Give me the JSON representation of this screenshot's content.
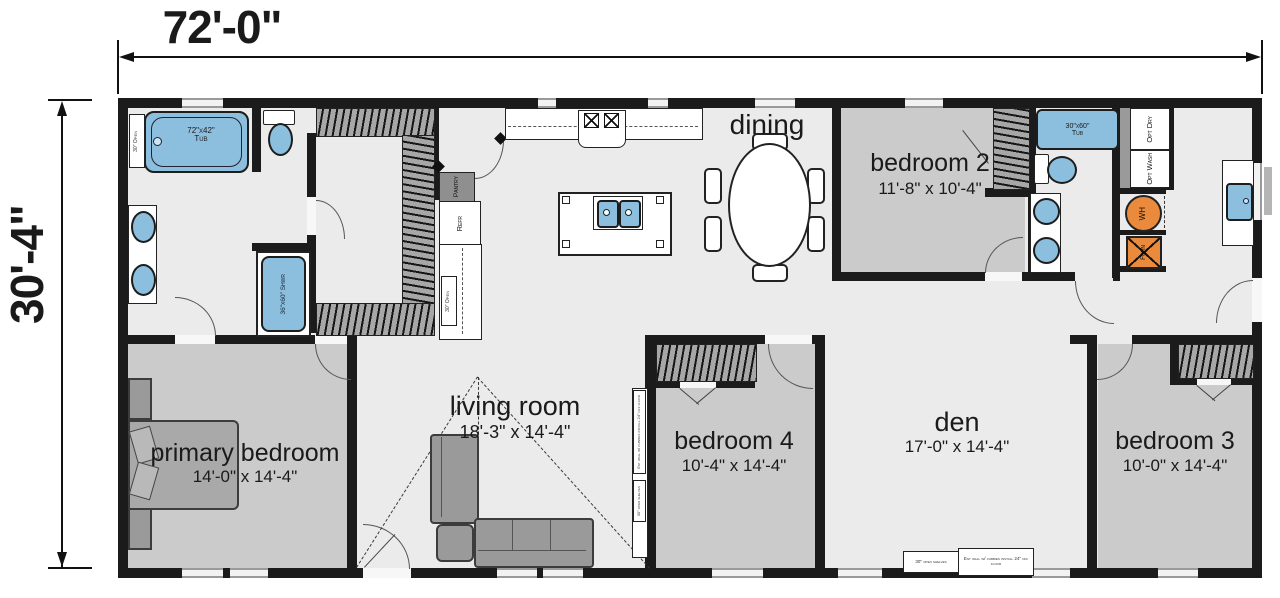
{
  "dimension_labels": {
    "width": "72'-0\"",
    "height": "30'-4\""
  },
  "rooms": {
    "dining": {
      "label": "dining"
    },
    "bedroom2": {
      "label": "bedroom 2",
      "size": "11'-8\" x 10'-4\""
    },
    "primary_bedroom": {
      "label": "primary bedroom",
      "size": "14'-0\" x 14'-4\""
    },
    "living_room": {
      "label": "living room",
      "size": "18'-3\" x 14'-4\""
    },
    "bedroom4": {
      "label": "bedroom 4",
      "size": "10'-4\" x 14'-4\""
    },
    "den": {
      "label": "den",
      "size": "17'-0\" x 14'-4\""
    },
    "bedroom3": {
      "label": "bedroom 3",
      "size": "10'-0\" x 14'-4\""
    }
  },
  "fixtures": {
    "primary_tub_size": "72\"x42\"",
    "primary_tub": "Tub",
    "hall_tub_size": "30\"x60\"",
    "hall_tub": "Tub",
    "shower": "36\"x60\" Shwr",
    "refrigerator": "Refr",
    "pantry": "Pantry",
    "optional_dryer": "Opt Dry",
    "optional_washer": "Opt Wash",
    "water_heater": "WH",
    "furnace": "Furn",
    "open_30": "30\" Open"
  },
  "notes": {
    "cubby_wall": "Ent wall w/ cubbies install 24\" off floor",
    "open_shelves": "30\" open shelves"
  },
  "colors": {
    "wall": "#1b1b1b",
    "fixture_blue": "#8cbede",
    "utility_orange": "#e98a3c",
    "bedroom_floor": "#cbcbcb",
    "common_floor": "#ebebeb",
    "closet_shade": "#a7a7a7"
  }
}
